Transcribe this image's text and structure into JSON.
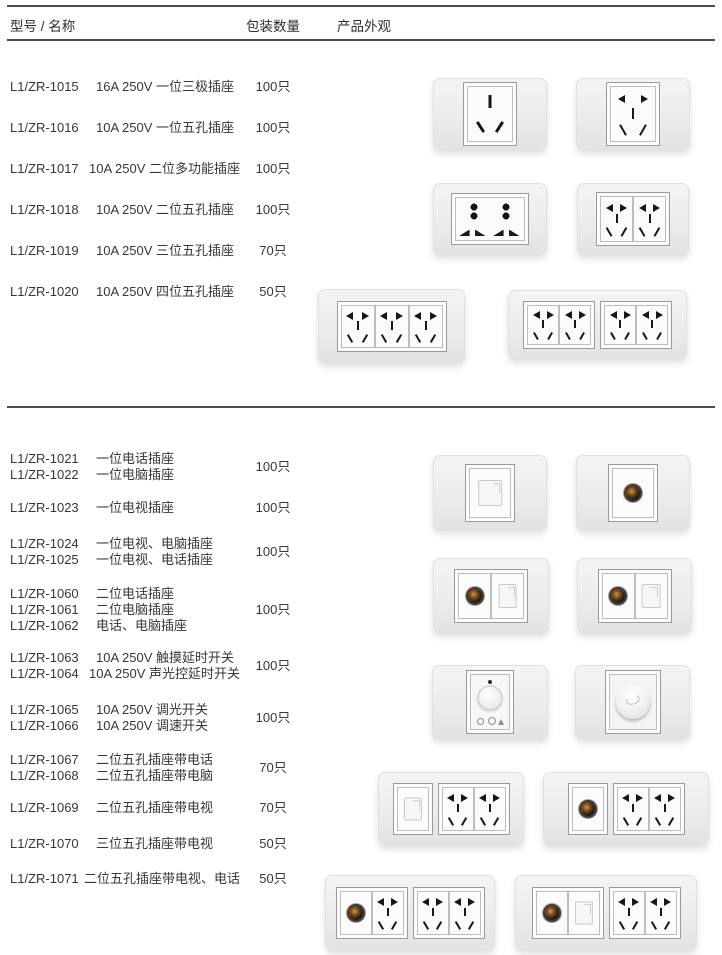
{
  "header": {
    "col_model_name": "型号 / 名称",
    "col_quantity": "包装数量",
    "col_appearance": "产品外观"
  },
  "sections": [
    {
      "groups": [
        {
          "items": [
            {
              "model": "L1/ZR-1015",
              "name": "16A 250V 一位三极插座"
            }
          ],
          "qty": "100只"
        },
        {
          "items": [
            {
              "model": "L1/ZR-1016",
              "name": "10A 250V 一位五孔插座"
            }
          ],
          "qty": "100只"
        },
        {
          "items": [
            {
              "model": "L1/ZR-1017",
              "name": "10A 250V 二位多功能插座"
            }
          ],
          "qty": "100只"
        },
        {
          "items": [
            {
              "model": "L1/ZR-1018",
              "name": "10A 250V 二位五孔插座"
            }
          ],
          "qty": "100只"
        },
        {
          "items": [
            {
              "model": "L1/ZR-1019",
              "name": "10A 250V 三位五孔插座"
            }
          ],
          "qty": "70只"
        },
        {
          "items": [
            {
              "model": "L1/ZR-1020",
              "name": "10A 250V 四位五孔插座"
            }
          ],
          "qty": "50只"
        }
      ],
      "appearance_icons": [
        "one-gang-three-pin-socket",
        "one-gang-five-hole-socket",
        "two-gang-multifunction-socket",
        "two-gang-five-hole-socket",
        "three-gang-five-hole-socket",
        "four-gang-five-hole-socket"
      ]
    },
    {
      "groups": [
        {
          "items": [
            {
              "model": "L1/ZR-1021",
              "name": "一位电话插座"
            },
            {
              "model": "L1/ZR-1022",
              "name": "一位电脑插座"
            }
          ],
          "qty": "100只"
        },
        {
          "items": [
            {
              "model": "L1/ZR-1023",
              "name": "一位电视插座"
            }
          ],
          "qty": "100只"
        },
        {
          "items": [
            {
              "model": "L1/ZR-1024",
              "name": "一位电视、电脑插座"
            },
            {
              "model": "L1/ZR-1025",
              "name": "一位电视、电话插座"
            }
          ],
          "qty": "100只"
        },
        {
          "items": [
            {
              "model": "L1/ZR-1060",
              "name": "二位电话插座"
            },
            {
              "model": "L1/ZR-1061",
              "name": "二位电脑插座"
            },
            {
              "model": "L1/ZR-1062",
              "name": "电话、电脑插座"
            }
          ],
          "qty": "100只"
        },
        {
          "items": [
            {
              "model": "L1/ZR-1063",
              "name": "10A 250V 触摸延时开关"
            },
            {
              "model": "L1/ZR-1064",
              "name": "10A 250V 声光控延时开关"
            }
          ],
          "qty": "100只"
        },
        {
          "items": [
            {
              "model": "L1/ZR-1065",
              "name": "10A 250V 调光开关"
            },
            {
              "model": "L1/ZR-1066",
              "name": "10A 250V 调速开关"
            }
          ],
          "qty": "100只"
        },
        {
          "items": [
            {
              "model": "L1/ZR-1067",
              "name": "二位五孔插座带电话"
            },
            {
              "model": "L1/ZR-1068",
              "name": "二位五孔插座带电脑"
            }
          ],
          "qty": "70只"
        },
        {
          "items": [
            {
              "model": "L1/ZR-1069",
              "name": "二位五孔插座带电视"
            }
          ],
          "qty": "70只"
        },
        {
          "items": [
            {
              "model": "L1/ZR-1070",
              "name": "三位五孔插座带电视"
            }
          ],
          "qty": "50只"
        },
        {
          "items": [
            {
              "model": "L1/ZR-1071",
              "name": "二位五孔插座带电视、电话"
            }
          ],
          "qty": "50只"
        }
      ],
      "appearance_icons": [
        "one-gang-rj-jack",
        "one-gang-tv-coax",
        "tv-coax-plus-rj-two-gang",
        "tv-coax-plus-rj-two-gang",
        "touch-delay-switch",
        "rotary-dimmer-knob",
        "rj-plus-two-five-hole",
        "tv-coax-plus-two-five-hole",
        "tv-coax-plus-three-five-hole",
        "tv-coax-rj-plus-two-five-hole"
      ]
    }
  ],
  "colors": {
    "page_bg": "#ffffff",
    "text": "#3a3a3a",
    "rule": "#4d4d4d",
    "plate_fill": "#ededed",
    "socket_face": "#fbfbfb",
    "slot": "#1a1a1a",
    "coax_brown": "#5a3a14"
  }
}
